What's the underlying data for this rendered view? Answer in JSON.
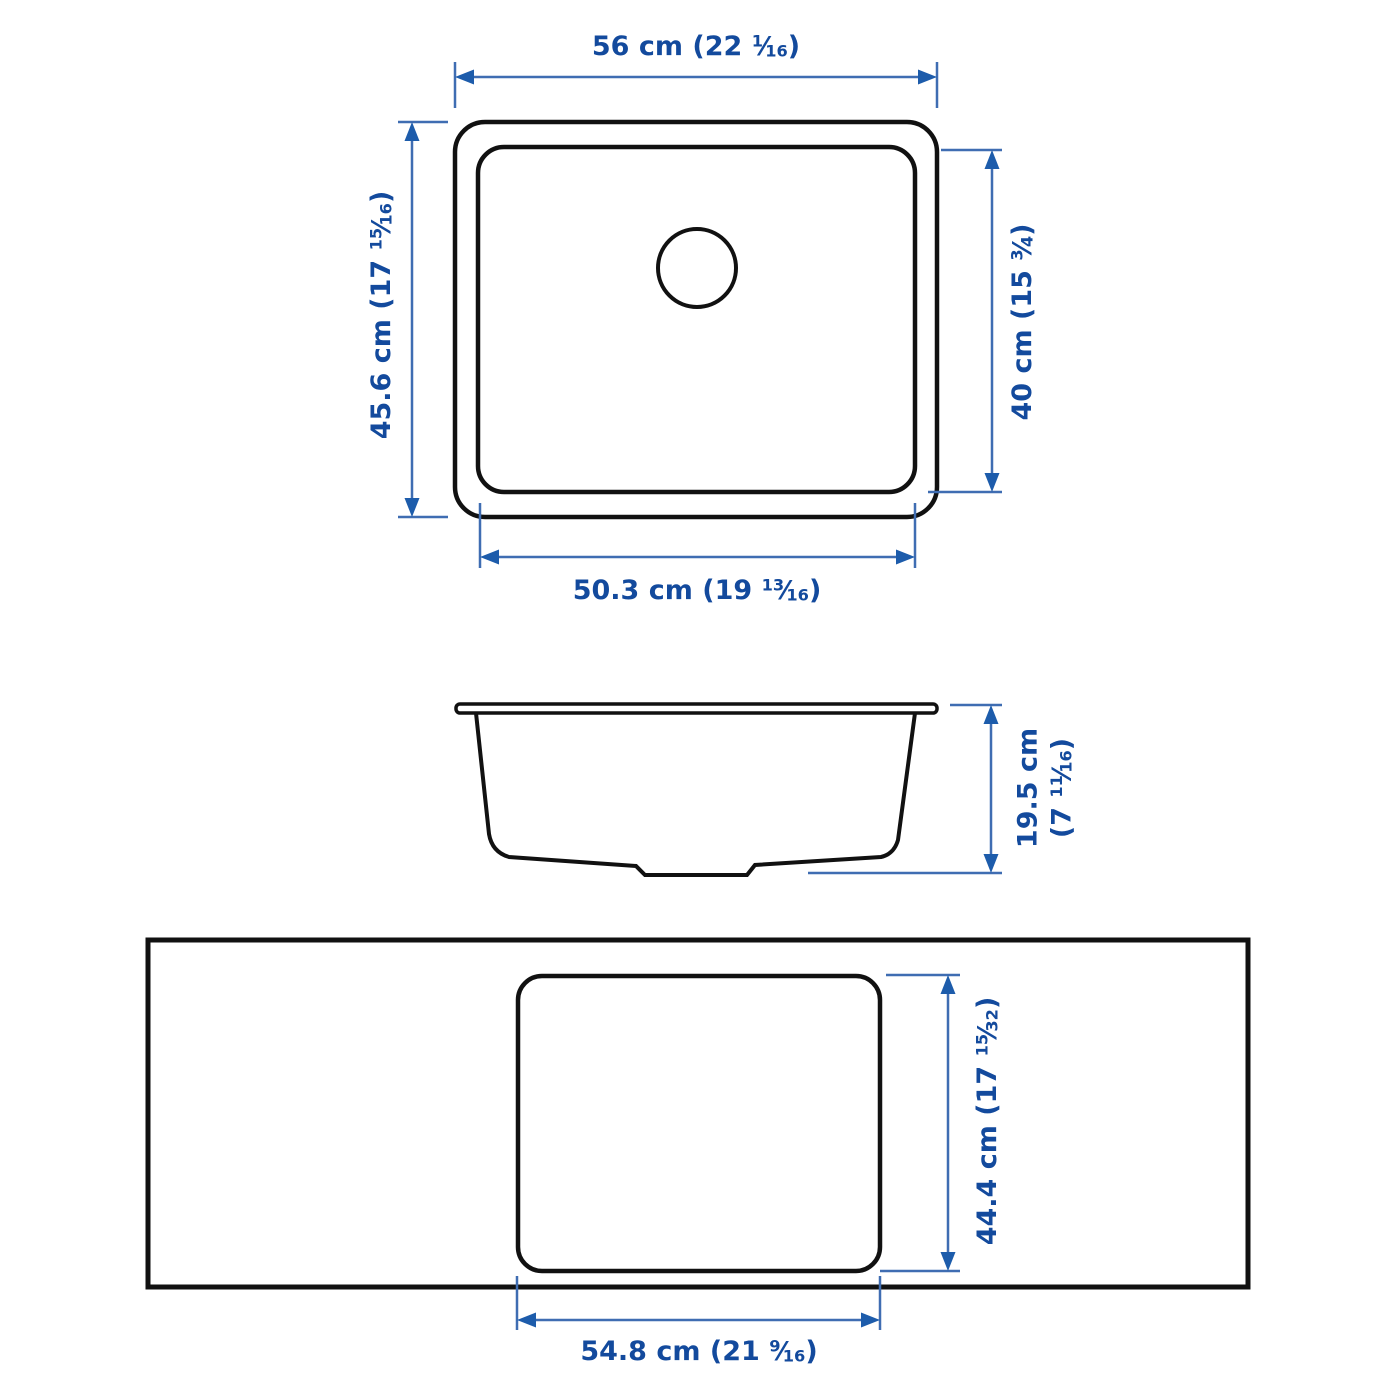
{
  "colors": {
    "background": "#ffffff",
    "outline": "#111111",
    "dim_line": "#3f6db2",
    "dim_text": "#134a9d",
    "arrow": "#1d5cab"
  },
  "labels": {
    "plan_outer_width": {
      "pre": "56 cm (22 ",
      "num": "1",
      "slash": "⁄",
      "den": "16",
      "post": ")"
    },
    "plan_outer_height": {
      "pre": "45.6 cm (17 ",
      "num": "15",
      "slash": "⁄",
      "den": "16",
      "post": ")"
    },
    "plan_inner_height": {
      "pre": "40 cm (15 ",
      "num": "3",
      "slash": "⁄",
      "den": "4",
      "post": ")"
    },
    "plan_inner_width": {
      "pre": "50.3 cm (19 ",
      "num": "13",
      "slash": "⁄",
      "den": "16",
      "post": ")"
    },
    "side_height": {
      "line1": "19.5 cm",
      "pre": "(7 ",
      "num": "11",
      "slash": "⁄",
      "den": "16",
      "post": ")"
    },
    "cutout_height": {
      "pre": "44.4 cm (17 ",
      "num": "15",
      "slash": "⁄",
      "den": "32",
      "post": ")"
    },
    "cutout_width": {
      "pre": "54.8 cm (21 ",
      "num": "9",
      "slash": "⁄",
      "den": "16",
      "post": ")"
    }
  }
}
